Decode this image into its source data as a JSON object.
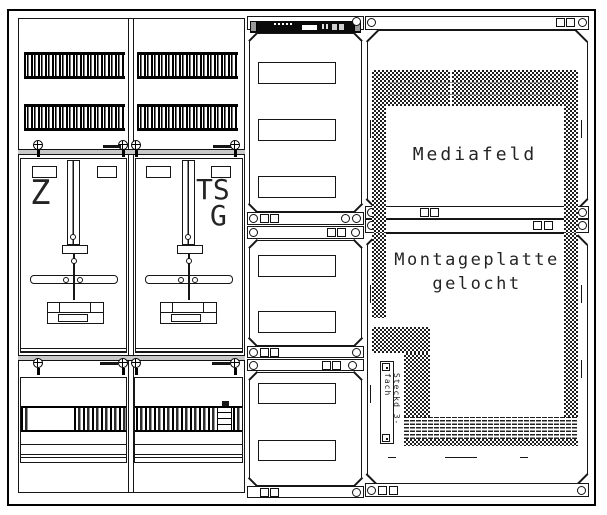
{
  "labels": {
    "meter_left": "Z",
    "tariff_line1": "TS",
    "tariff_line2": "G",
    "media_field": "Mediafeld",
    "mounting_plate_line1": "Montageplatte",
    "mounting_plate_line2": "gelocht",
    "socket_strip": "Steckd 3-fach"
  },
  "colors": {
    "ink": "#161616",
    "paper": "#ffffff"
  }
}
